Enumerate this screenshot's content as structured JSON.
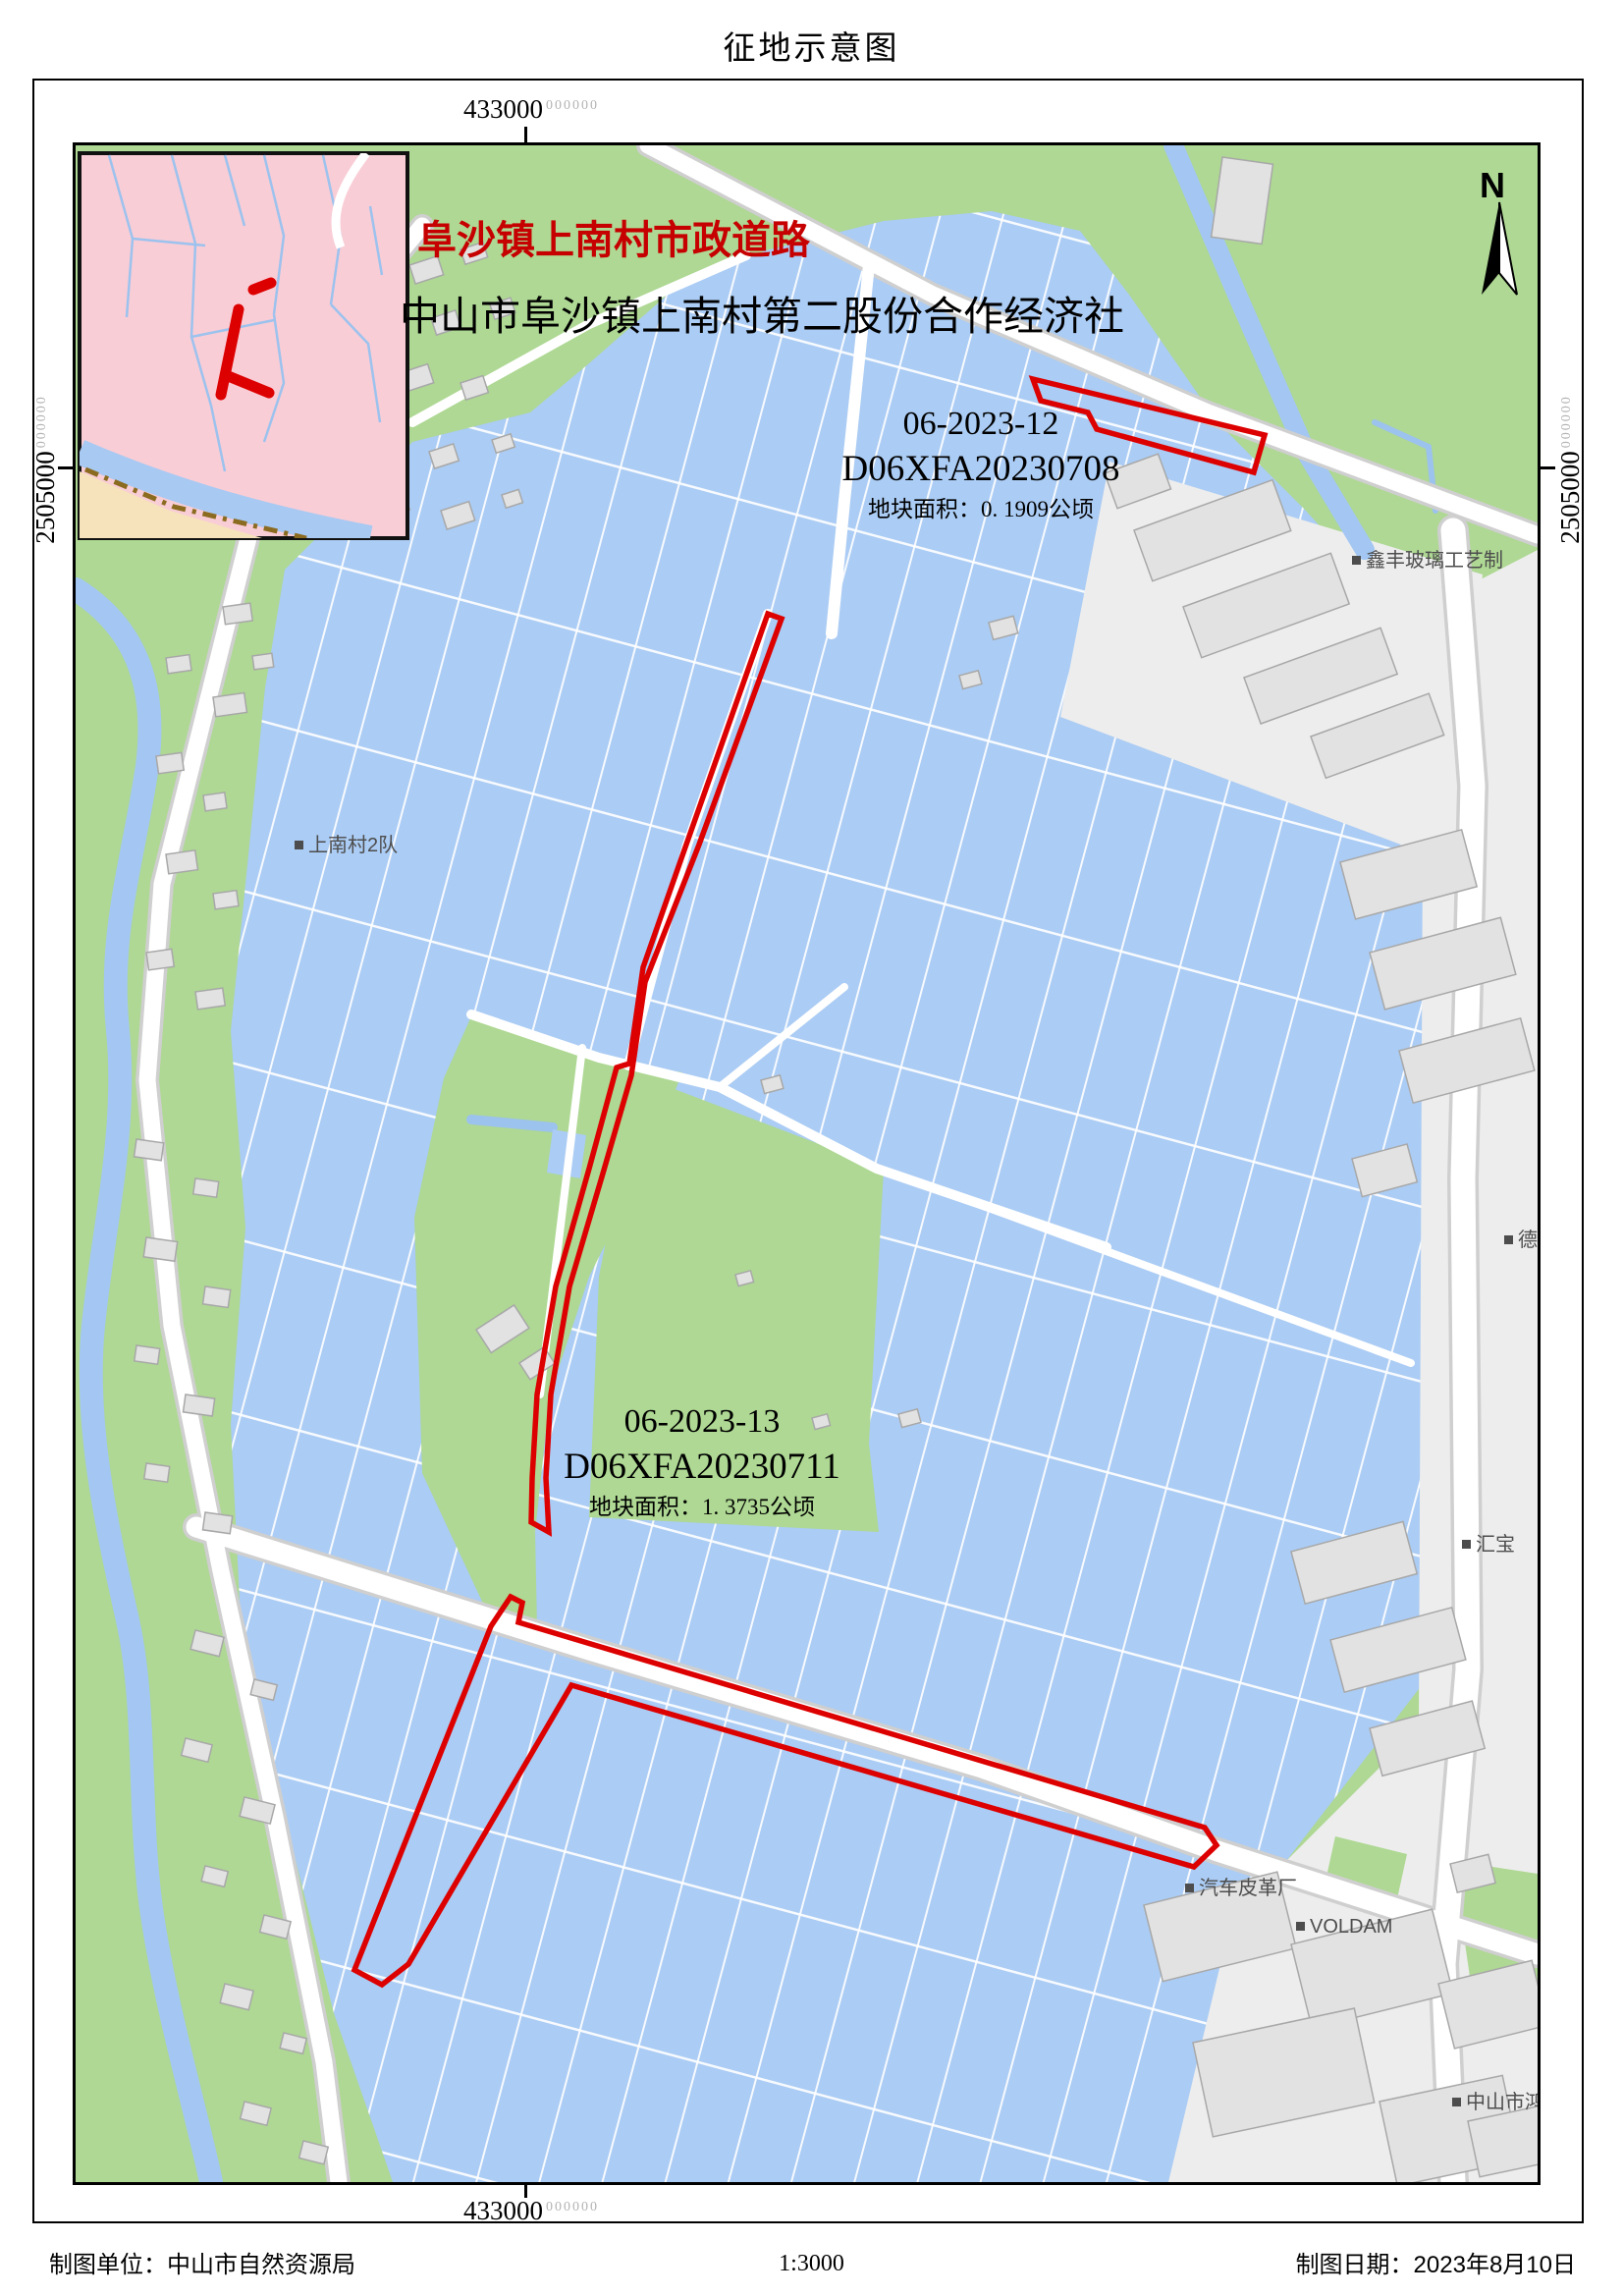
{
  "title": "征地示意图",
  "header": {
    "line1": "阜沙镇上南村市政道路",
    "line2": "中山市阜沙镇上南村第二股份合作经济社"
  },
  "coordinates": {
    "top": "433000",
    "bottom": "433000",
    "left": "2505000",
    "right": "2505000",
    "superscript": "000000"
  },
  "north": {
    "label": "N"
  },
  "parcels": [
    {
      "id": "06-2023-12",
      "code": "D06XFA20230708",
      "area": "地块面积：0. 1909公顷"
    },
    {
      "id": "06-2023-13",
      "code": "D06XFA20230711",
      "area": "地块面积：1. 3735公顷"
    }
  ],
  "map_labels": [
    {
      "text": "上南村2队"
    },
    {
      "text": "鑫丰玻璃工艺制"
    },
    {
      "text": "德"
    },
    {
      "text": "汇宝"
    },
    {
      "text": "汽车皮革厂"
    },
    {
      "text": "VOLDAM"
    },
    {
      "text": "中山市鸿"
    }
  ],
  "footer": {
    "agency": "制图单位：中山市自然资源局",
    "scale": "1:3000",
    "date": "制图日期：2023年8月10日"
  },
  "colors": {
    "parcel_red": "#dd0000",
    "water": "#abccf4",
    "green": "#aed893",
    "inset_pink": "#f9cdd6",
    "inset_tan": "#f6e3bb",
    "boundary_brown": "#8b6b1f",
    "road": "#ffffff",
    "building": "#e2e2e2",
    "label_gray": "#4d4d4d",
    "header_red": "#c60000"
  }
}
